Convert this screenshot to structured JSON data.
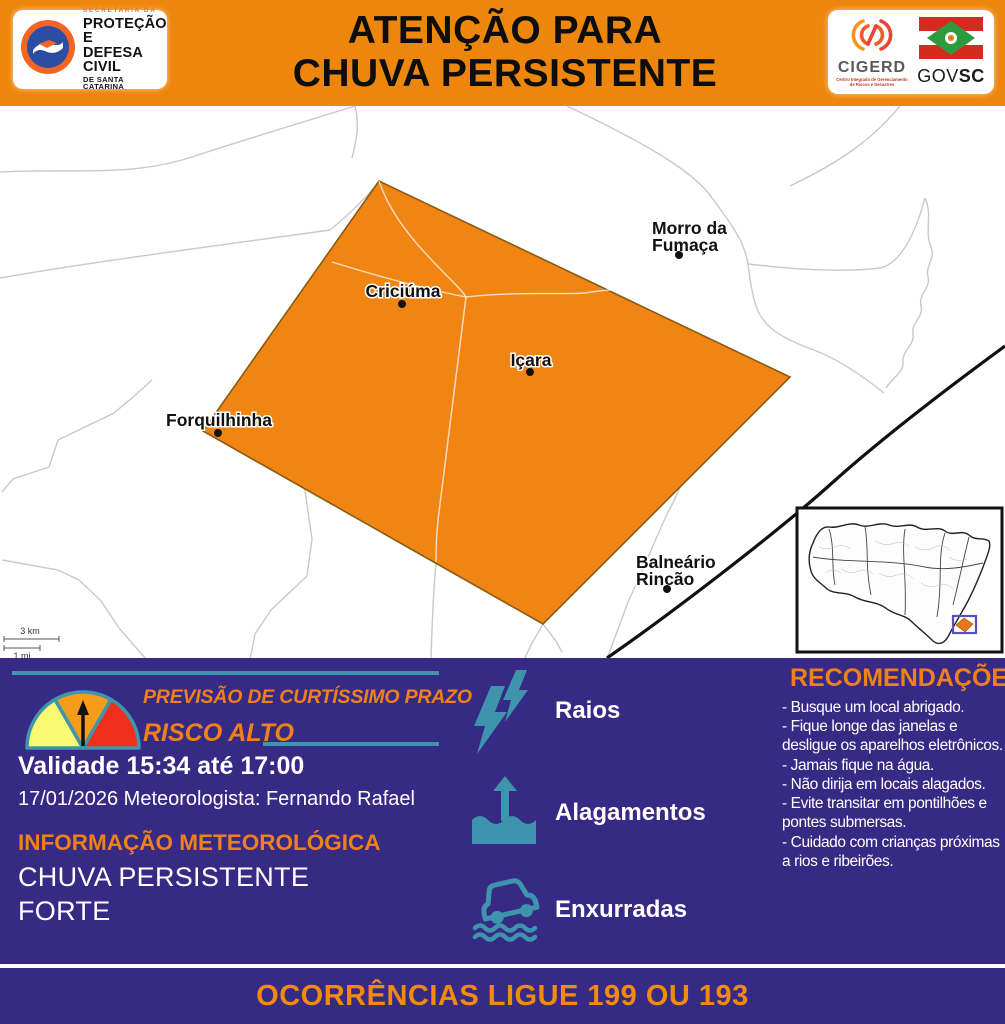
{
  "colors": {
    "header_orange": "#ED860D",
    "alert_area_orange": "#F08514",
    "panel_purple": "#372A85",
    "teal_accent": "#3E95AE",
    "accent_orange_text": "#F08019",
    "gauge_yellow": "#FAFA72",
    "gauge_orange": "#F59C1B",
    "gauge_red": "#EF2E1B"
  },
  "header": {
    "title_line1": "ATENÇÃO PARA",
    "title_line2": "CHUVA PERSISTENTE",
    "defesa_civil_logo": {
      "top": "SECRETARIA DA",
      "line1": "PROTEÇÃO E",
      "line2": "DEFESA CIVIL",
      "line3": "DE SANTA CATARINA"
    },
    "cigerd_logo": {
      "name": "CIGERD",
      "subtitle": "Centro Integrado de Gerenciamento de Riscos e Desastres"
    },
    "gov_logo": {
      "gov": "GOV",
      "sc": "SC"
    }
  },
  "map": {
    "cities": [
      {
        "lines": [
          "Criciúma"
        ]
      },
      {
        "lines": [
          "Içara"
        ]
      },
      {
        "lines": [
          "Morro da",
          "Fumaça"
        ]
      },
      {
        "lines": [
          "Forquilhinha"
        ]
      },
      {
        "lines": [
          "Balneário",
          "Rincão"
        ]
      }
    ],
    "scale_km": "3 km",
    "scale_mi": "1 mi"
  },
  "panel": {
    "forecast_title": "PREVISÃO DE CURTÍSSIMO PRAZO",
    "risk_label": "RISCO ALTO",
    "validity": "Validade 15:34 até 17:00",
    "date_meteorologist": "17/01/2026 Meteorologista: Fernando Rafael",
    "info_title": "INFORMAÇÃO METEOROLÓGICA",
    "info_line1": "CHUVA PERSISTENTE",
    "info_line2": "FORTE",
    "hazards": [
      {
        "label": "Raios",
        "icon": "lightning-icon"
      },
      {
        "label": "Alagamentos",
        "icon": "flood-icon"
      },
      {
        "label": "Enxurradas",
        "icon": "flash-flood-icon"
      }
    ],
    "recommendations": {
      "title": "RECOMENDAÇÕES",
      "items": [
        "- Busque um local abrigado.",
        "- Fique longe das janelas e desligue os aparelhos eletrônicos.",
        "- Jamais fique na água.",
        "- Não dirija em locais alagados.",
        "- Evite transitar em pontilhões e pontes submersas.",
        "- Cuidado com crianças próximas a rios e ribeirões."
      ]
    }
  },
  "footer": {
    "text": "OCORRÊNCIAS LIGUE 199 OU 193"
  }
}
